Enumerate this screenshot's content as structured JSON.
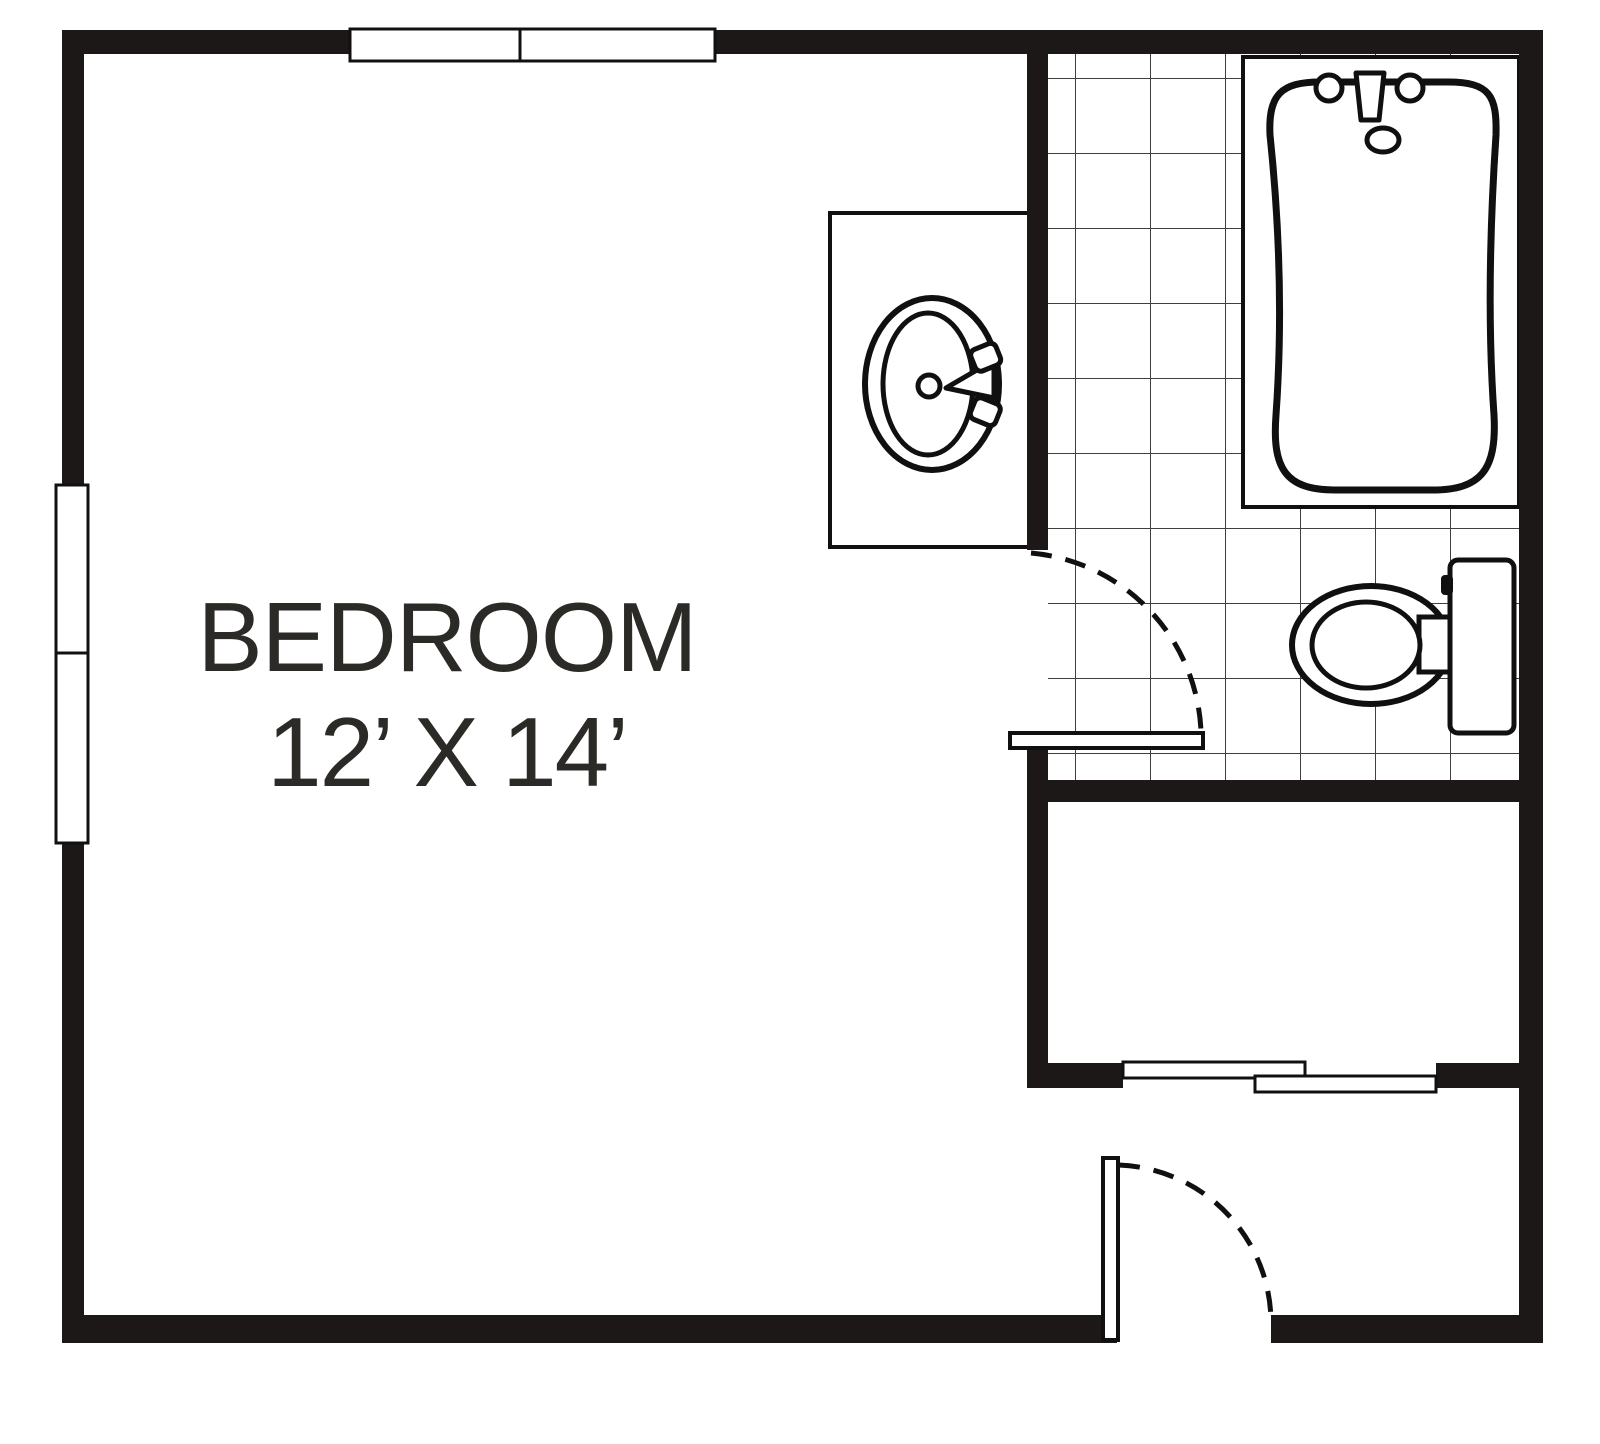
{
  "labels": {
    "room_name": "BEDROOM",
    "room_size": "12’ X 14’"
  },
  "fixture_names": [
    "bathtub",
    "sink",
    "vanity-counter",
    "toilet",
    "bathroom-door",
    "entry-door",
    "closet-sliding-doors",
    "top-window",
    "left-window",
    "bathroom-tile-floor"
  ],
  "colors": {
    "wall": "#1b1817",
    "outline": "#101010",
    "tile_grid": "#3f3f3f",
    "background": "#ffffff",
    "label_text": "#2b2a27"
  }
}
